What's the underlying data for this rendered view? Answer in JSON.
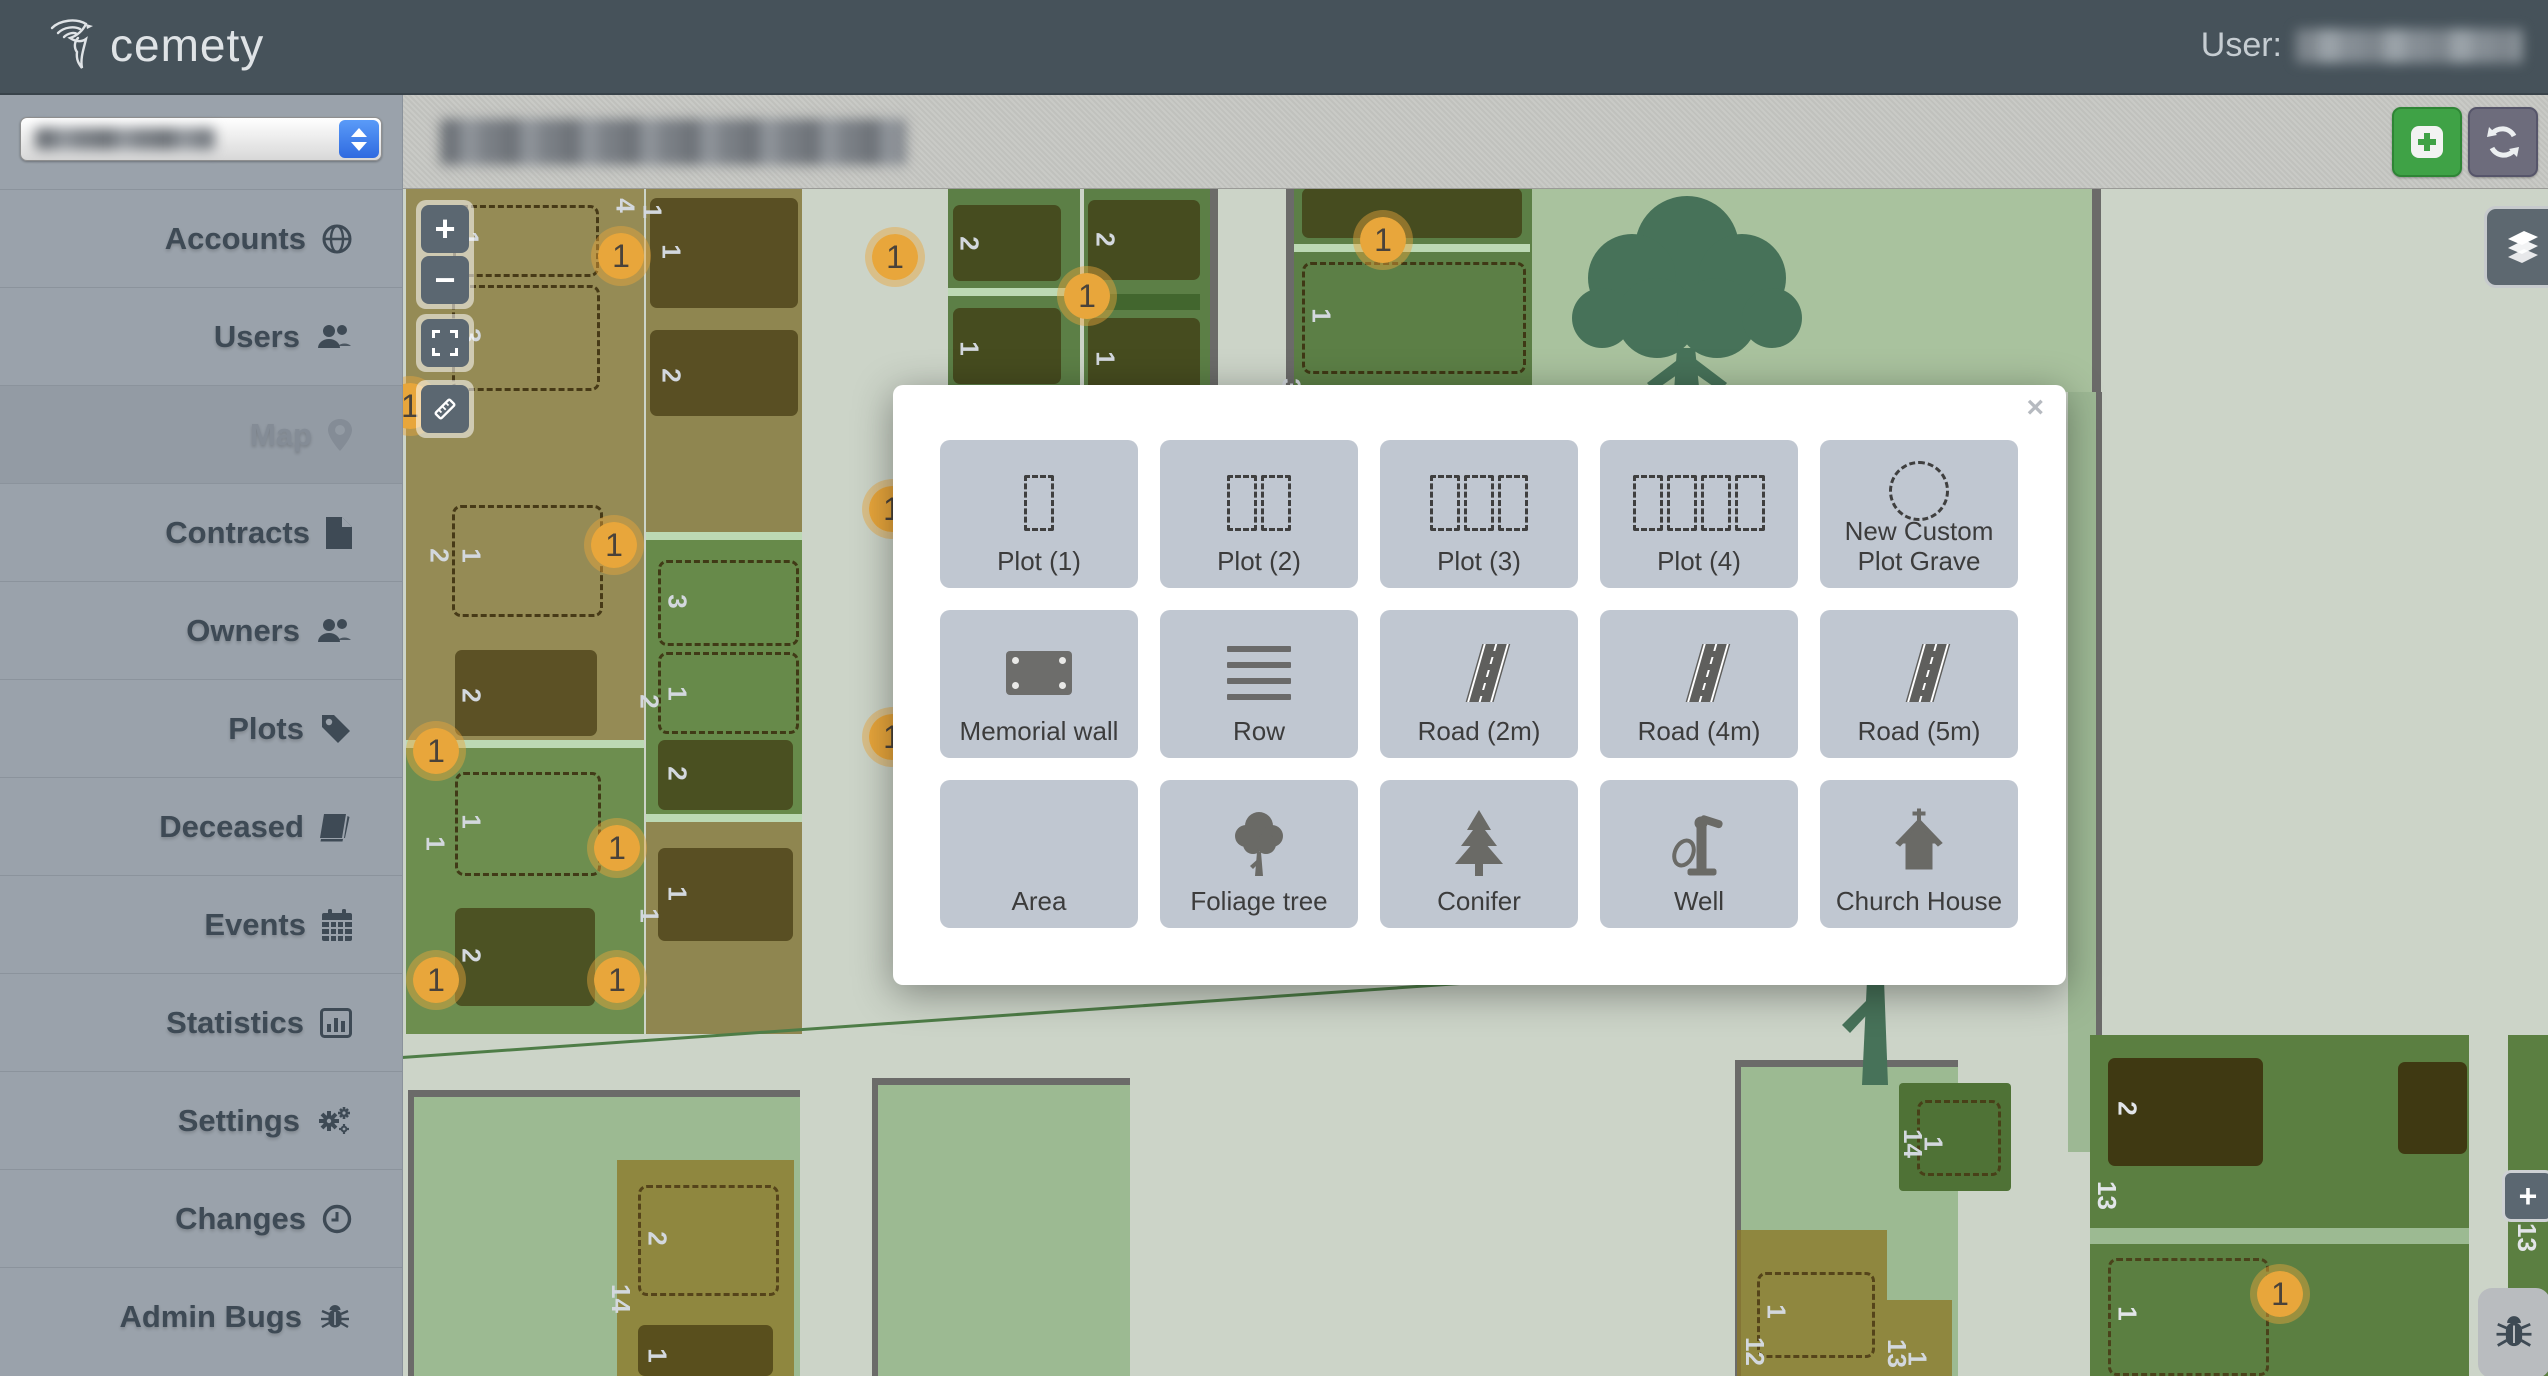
{
  "header": {
    "brand": "cemety",
    "user_label": "User:"
  },
  "sidebar": {
    "items": [
      {
        "label": "Accounts"
      },
      {
        "label": "Users"
      },
      {
        "label": "Map",
        "active": true
      },
      {
        "label": "Contracts"
      },
      {
        "label": "Owners"
      },
      {
        "label": "Plots"
      },
      {
        "label": "Deceased"
      },
      {
        "label": "Events"
      },
      {
        "label": "Statistics"
      },
      {
        "label": "Settings"
      },
      {
        "label": "Changes"
      },
      {
        "label": "Admin Bugs"
      }
    ]
  },
  "modal": {
    "close": "×",
    "items": [
      {
        "label": "Plot (1)"
      },
      {
        "label": "Plot (2)"
      },
      {
        "label": "Plot (3)"
      },
      {
        "label": "Plot (4)"
      },
      {
        "label": "New Custom Plot Grave"
      },
      {
        "label": "Memorial wall"
      },
      {
        "label": "Row"
      },
      {
        "label": "Road (2m)"
      },
      {
        "label": "Road (4m)"
      },
      {
        "label": "Road (5m)"
      },
      {
        "label": "Area"
      },
      {
        "label": "Foliage tree"
      },
      {
        "label": "Conifer"
      },
      {
        "label": "Well"
      },
      {
        "label": "Church House"
      }
    ]
  },
  "map": {
    "zoom_in": "+",
    "zoom_out": "−",
    "markers": [
      "1",
      "1",
      "1",
      "1",
      "1",
      "1",
      "1",
      "1",
      "1",
      "1",
      "1",
      "1",
      "1"
    ],
    "labels": [
      "4",
      "1",
      "1",
      "3",
      "1",
      "2",
      "2",
      "1",
      "1",
      "2",
      "1",
      "2",
      "3",
      "1",
      "2",
      "2",
      "1",
      "1",
      "2",
      "1",
      "2",
      "1",
      "1",
      "3",
      "2",
      "14",
      "1",
      "1",
      "12",
      "14",
      "1",
      "13",
      "1",
      "2",
      "13",
      "1",
      "13"
    ]
  },
  "colors": {
    "header_bg": "#46525a",
    "sidebar_bg": "#9aa2ab",
    "accent_green": "#3fa246",
    "marker_orange": "#e8a63b",
    "tile_bg": "#c0c7d1",
    "map_bg": "#ccd4c8"
  }
}
